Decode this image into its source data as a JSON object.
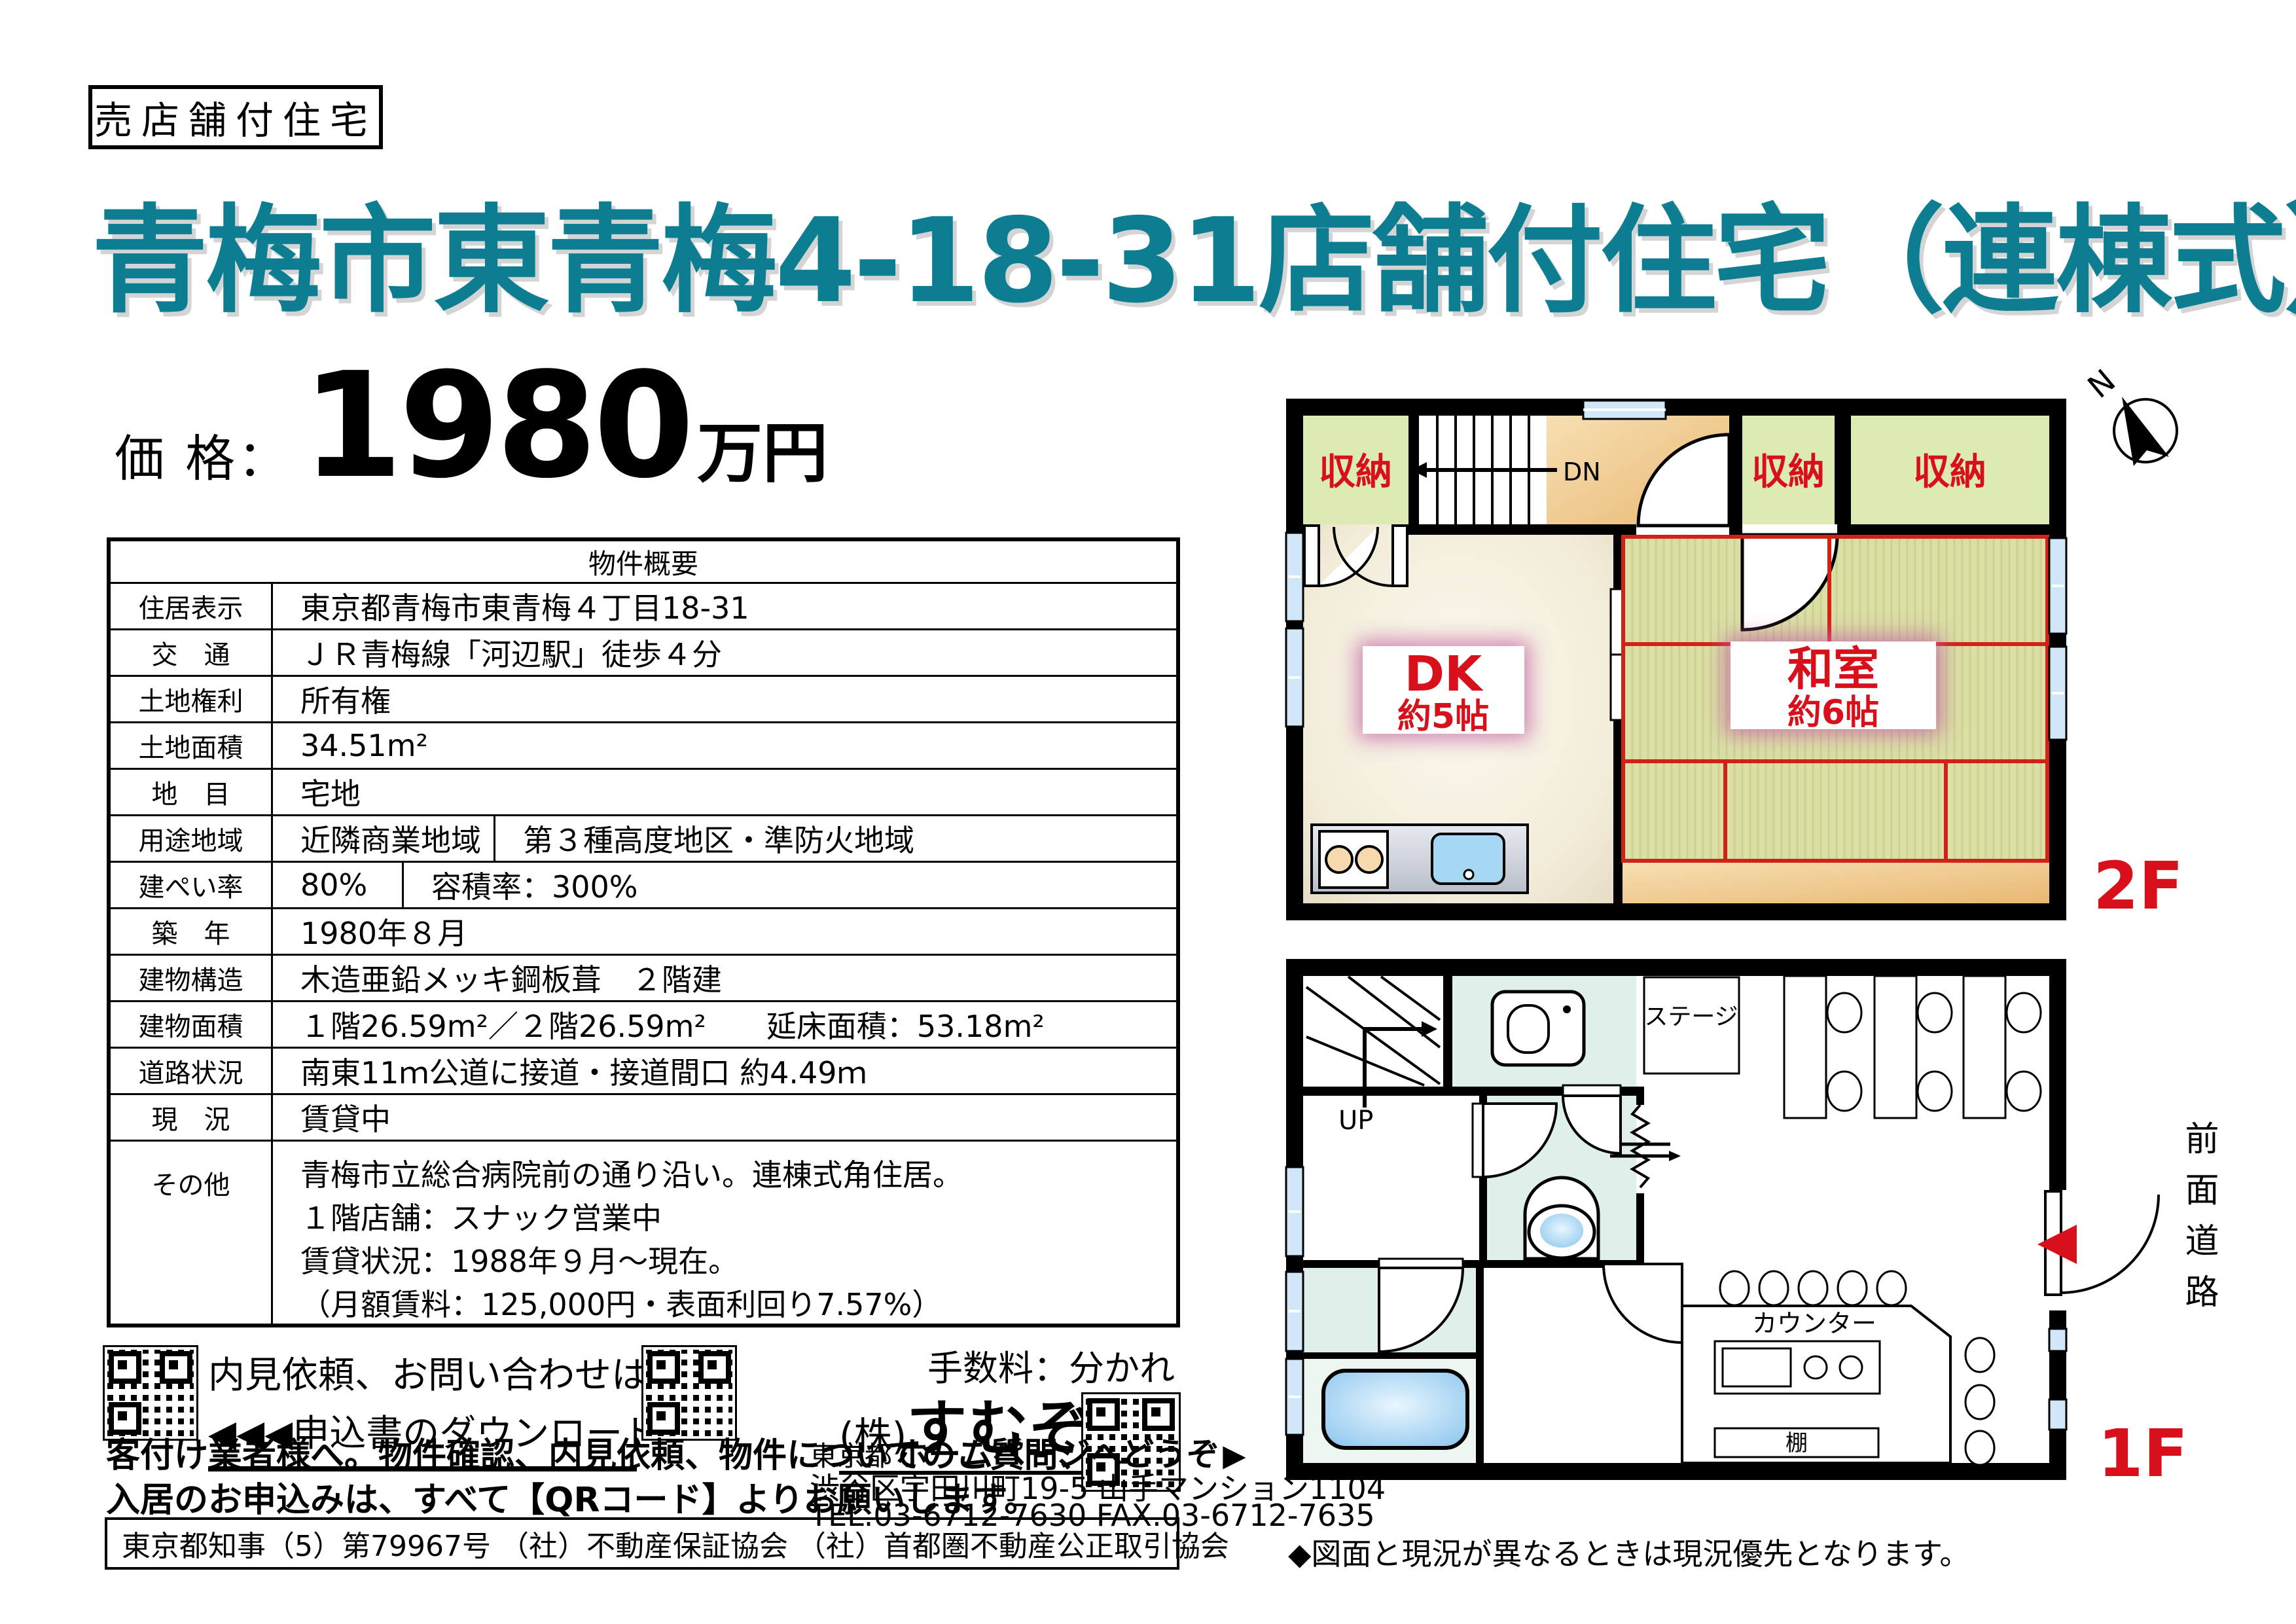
{
  "header": {
    "badge": "売店舗付住宅",
    "title": "青梅市東青梅4-18-31店舗付住宅（連棟式）"
  },
  "price": {
    "label": "価 格：",
    "amount": "1980",
    "unit": "万円"
  },
  "spec": {
    "title": "物件概要",
    "rows": [
      {
        "label": "住居表示",
        "value": "東京都青梅市東青梅４丁目18-31"
      },
      {
        "label": "交　通",
        "value": "ＪＲ青梅線「河辺駅」徒歩４分"
      },
      {
        "label": "土地権利",
        "value": "所有権"
      },
      {
        "label": "土地面積",
        "value": "34.51m²"
      },
      {
        "label": "地　目",
        "value": "宅地"
      },
      {
        "label": "用途地域",
        "value": "近隣商業地域",
        "value2": "第３種高度地区・準防火地域"
      },
      {
        "label": "建ぺい率",
        "value": "80%",
        "value2": "容積率：300%"
      },
      {
        "label": "築　年",
        "value": "1980年８月"
      },
      {
        "label": "建物構造",
        "value": "木造亜鉛メッキ鋼板葺　２階建"
      },
      {
        "label": "建物面積",
        "value": "１階26.59m²／２階26.59m²　　延床面積：53.18m²"
      },
      {
        "label": "道路状況",
        "value": "南東11ｍ公道に接道・接道間口 約4.49ｍ"
      },
      {
        "label": "現　況",
        "value": "賃貸中"
      },
      {
        "label": "その他",
        "lines": [
          "青梅市立総合病院前の通り沿い。連棟式角住居。",
          "１階店舗：スナック営業中",
          "賃貸状況：1988年９月～現在。",
          "（月額賃料：125,000円・表面利回り7.57%）"
        ]
      }
    ]
  },
  "contact": {
    "inquiry_text": "内見依頼、お問い合わせは",
    "inquiry_arrows": "▶▶▶",
    "download_arrows": "◀◀◀",
    "download_text": "申込書のダウンロード",
    "fee": "手数料：分かれ",
    "company_prefix": "(株)",
    "company_name": "すむぞう",
    "hp_prefix": "東京都",
    "hp_text": "ホームページへどうぞ",
    "hp_arrow": "▶",
    "address": "渋谷区宇田川町19-5 山手マンション1104",
    "tel": "TEL.03-6712-7630  FAX.03-6712-7635",
    "agent_line1": "客付け業者様へ。物件確認、内見依頼、物件についてのご質問、",
    "agent_line2": "入居のお申込みは、すべて【QRコード】よりお願いします。",
    "license": "東京都知事（5）第79967号 （社）不動産保証協会 （社）首都圏不動産公正取引協会"
  },
  "plan2f": {
    "floor": "2F",
    "storage": "収納",
    "dn": "DN",
    "dk_name": "DK",
    "dk_size": "約5帖",
    "tatami_name": "和室",
    "tatami_size": "約6帖",
    "north": "N"
  },
  "plan1f": {
    "floor": "1F",
    "up": "UP",
    "stage": "ステージ",
    "counter": "カウンター",
    "shelf": "棚",
    "road": "前面道路"
  },
  "note": "◆図面と現況が異なるときは現況優先となります。"
}
